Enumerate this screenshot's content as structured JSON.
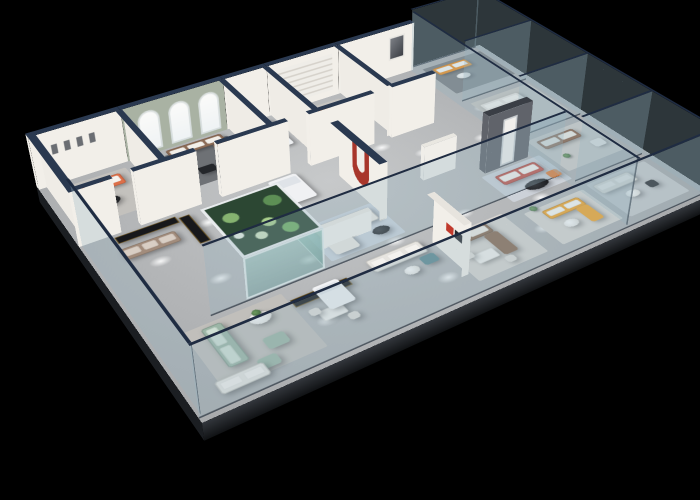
{
  "meta": {
    "description": "3D isometric cutaway rendering of a furniture showroom floor plan on a black background, with white partition walls capped in navy, a sage wall with three arched windows, a planted glass aquarium display, glass perimeter balustrades and many sofa vignettes in orange, brown, teal, sage, red and yellow.",
    "background": "#000000"
  },
  "camera": {
    "perspective": 1100,
    "originX": 373,
    "originY": 190,
    "rotateX": 55,
    "rotateZ": -33,
    "planeW": 560,
    "planeH": 380,
    "planeLeft": 93,
    "planeTop": 0
  },
  "palette": {
    "floor": "#b3b5b7",
    "slabEdge": "#23262b",
    "wallFace": "#f2efe9",
    "wallCap": "#2a3950",
    "sage": "#a9b2a3",
    "charcoal": "#60636a",
    "glass": "rgba(148,178,192,0.30)",
    "glassRail": "#1f2c42",
    "orange": "#ef8d1f",
    "coral": "#dd6f48",
    "red": "#c0544a",
    "brown": "#8d6c56",
    "teal": "#6e8d94",
    "green": "#9cb6a6",
    "yellow": "#f2a42a",
    "cream": "#ebe8e2",
    "cabinet": "#17181b"
  },
  "floor": {
    "edgeDepth": 20
  },
  "walls": [
    {
      "n": "back-wall-room-a",
      "d": "h",
      "x": 0,
      "y": 0,
      "l": 95,
      "t": 8,
      "h": 62,
      "face": "#f2efe9",
      "cap": "#2a3950",
      "f": [
        "s",
        "w"
      ],
      "decal": "frames"
    },
    {
      "n": "back-wall-arch-room",
      "d": "h",
      "x": 95,
      "y": 0,
      "l": 115,
      "t": 8,
      "h": 62,
      "face": "#a9b2a3",
      "cap": "#2a3950",
      "f": [
        "s"
      ],
      "decal": "arches"
    },
    {
      "n": "back-wall-room-c",
      "d": "h",
      "x": 210,
      "y": 0,
      "l": 52,
      "t": 8,
      "h": 62,
      "face": "#f2efe9",
      "cap": "#2a3950",
      "f": [
        "s"
      ]
    },
    {
      "n": "back-wall-room-d",
      "d": "h",
      "x": 262,
      "y": 0,
      "l": 90,
      "t": 8,
      "h": 62,
      "face": "#f2efe9",
      "cap": "#2a3950",
      "f": [
        "s"
      ],
      "decal": "stripes"
    },
    {
      "n": "back-wall-room-e",
      "d": "h",
      "x": 352,
      "y": 0,
      "l": 103,
      "t": 8,
      "h": 62,
      "face": "#f2efe9",
      "cap": "#2a3950",
      "f": [
        "s"
      ],
      "decal": "art"
    },
    {
      "n": "left-outer-wall",
      "d": "v",
      "x": 0,
      "y": 0,
      "l": 118,
      "t": 8,
      "h": 62,
      "face": "#efece6",
      "cap": "#2a3950",
      "f": [
        "e",
        "s"
      ]
    },
    {
      "n": "divider-a-b",
      "d": "v",
      "x": 90,
      "y": 8,
      "l": 106,
      "t": 7,
      "h": 62,
      "face": "#efece6",
      "cap": "#2a3950",
      "f": [
        "e",
        "s"
      ]
    },
    {
      "n": "divider-b-c",
      "d": "v",
      "x": 205,
      "y": 8,
      "l": 106,
      "t": 7,
      "h": 62,
      "face": "#efece6",
      "cap": "#2a3950",
      "f": [
        "e",
        "s"
      ]
    },
    {
      "n": "divider-c-d",
      "d": "v",
      "x": 257,
      "y": 8,
      "l": 106,
      "t": 7,
      "h": 62,
      "face": "#efece6",
      "cap": "#2a3950",
      "f": [
        "e",
        "s"
      ]
    },
    {
      "n": "divider-d-e",
      "d": "v",
      "x": 347,
      "y": 8,
      "l": 106,
      "t": 7,
      "h": 62,
      "face": "#efece6",
      "cap": "#2a3950",
      "f": [
        "e",
        "s"
      ]
    },
    {
      "n": "room-front-wall-1",
      "d": "h",
      "x": 0,
      "y": 112,
      "l": 42,
      "t": 7,
      "h": 62,
      "face": "#f2efe9",
      "cap": "#2a3950",
      "f": [
        "s",
        "e"
      ]
    },
    {
      "n": "room-front-wall-2",
      "d": "h",
      "x": 62,
      "y": 112,
      "l": 64,
      "t": 7,
      "h": 62,
      "face": "#f2efe9",
      "cap": "#2a3950",
      "f": [
        "s",
        "e",
        "w"
      ]
    },
    {
      "n": "room-front-wall-3",
      "d": "h",
      "x": 148,
      "y": 112,
      "l": 78,
      "t": 7,
      "h": 62,
      "face": "#f2efe9",
      "cap": "#2a3950",
      "f": [
        "s",
        "w"
      ]
    },
    {
      "n": "room-front-wall-4",
      "d": "h",
      "x": 250,
      "y": 112,
      "l": 78,
      "t": 7,
      "h": 62,
      "face": "#f2efe9",
      "cap": "#2a3950",
      "f": [
        "s",
        "w"
      ]
    },
    {
      "n": "room-front-wall-5",
      "d": "h",
      "x": 350,
      "y": 112,
      "l": 56,
      "t": 7,
      "h": 62,
      "face": "#f2efe9",
      "cap": "#2a3950",
      "f": [
        "s",
        "w"
      ]
    },
    {
      "n": "red-arch-feature-wall",
      "d": "v",
      "x": 256,
      "y": 150,
      "l": 88,
      "t": 9,
      "h": 66,
      "face": "#f2efe9",
      "cap": "#2a3950",
      "f": [
        "e",
        "s"
      ],
      "decal": "redj"
    },
    {
      "n": "charcoal-feature-wall",
      "d": "h",
      "x": 392,
      "y": 218,
      "l": 56,
      "t": 10,
      "h": 68,
      "face": "#60636a",
      "cap": "#3a3e45",
      "f": [
        "s",
        "w",
        "e"
      ],
      "decal": "door"
    },
    {
      "n": "curved-low-partition",
      "d": "h",
      "x": 186,
      "y": 240,
      "l": 56,
      "t": 6,
      "h": 24,
      "face": "#f4f2ee",
      "cap": "#eceae4",
      "f": [
        "s"
      ]
    },
    {
      "n": "curved-low-partition-2",
      "d": "h",
      "x": 332,
      "y": 198,
      "l": 40,
      "t": 6,
      "h": 40,
      "face": "#f0eee9",
      "cap": "#e9e7e1",
      "f": [
        "s",
        "w"
      ]
    },
    {
      "n": "logo-wall",
      "d": "v",
      "x": 272,
      "y": 292,
      "l": 56,
      "t": 8,
      "h": 58,
      "face": "#f2efe9",
      "cap": "#e7e4de",
      "f": [
        "e",
        "s"
      ],
      "decal": "logo"
    },
    {
      "n": "aquarium-display",
      "d": "h",
      "x": 96,
      "y": 186,
      "l": 80,
      "t": 84,
      "h": 46,
      "face": "aqua",
      "cap": "aqua",
      "f": [
        "s",
        "e"
      ]
    }
  ],
  "glass": [
    {
      "n": "glass-front-balustrade",
      "d": "h",
      "x": 0,
      "y": 372,
      "l": 560,
      "h": 76
    },
    {
      "n": "glass-left-balustrade",
      "d": "v",
      "x": 0,
      "y": 118,
      "l": 254,
      "h": 76
    },
    {
      "n": "glass-right-facade",
      "d": "v",
      "x": 552,
      "y": 0,
      "l": 372,
      "h": 76
    },
    {
      "n": "glass-back-right",
      "d": "h",
      "x": 455,
      "y": 0,
      "l": 97,
      "h": 76
    },
    {
      "n": "glass-mid-partition",
      "d": "h",
      "x": 60,
      "y": 270,
      "l": 392,
      "h": 76
    },
    {
      "n": "glass-wing-main",
      "d": "v",
      "x": 452,
      "y": 8,
      "l": 364,
      "h": 76
    },
    {
      "n": "glass-wing-divider-1",
      "d": "h",
      "x": 459,
      "y": 96,
      "l": 93,
      "h": 76
    },
    {
      "n": "glass-wing-divider-2",
      "d": "h",
      "x": 459,
      "y": 190,
      "l": 93,
      "h": 76
    },
    {
      "n": "glass-wing-divider-3",
      "d": "h",
      "x": 459,
      "y": 286,
      "l": 93,
      "h": 76
    }
  ],
  "furniture": [
    {
      "n": "rug-room-a",
      "t": "rug",
      "x": 10,
      "y": 18,
      "w": 78,
      "h": 76,
      "c": "#c3c1bd"
    },
    {
      "n": "rug-arch-room",
      "t": "rug",
      "x": 114,
      "y": 20,
      "w": 90,
      "h": 70,
      "c": "#6e7175"
    },
    {
      "n": "rug-room-d",
      "t": "rug",
      "x": 264,
      "y": 18,
      "w": 82,
      "h": 70,
      "c": "#c6c4c0"
    },
    {
      "n": "rug-wing-1",
      "t": "rug",
      "x": 464,
      "y": 14,
      "w": 86,
      "h": 68,
      "c": "#7a7d81"
    },
    {
      "n": "rug-center-blue",
      "t": "rug",
      "x": 186,
      "y": 208,
      "w": 82,
      "h": 58,
      "c": "#ccd4dd"
    },
    {
      "n": "rug-feature-room",
      "t": "rug",
      "x": 384,
      "y": 232,
      "w": 76,
      "h": 52,
      "c": "#ccd1d8"
    },
    {
      "n": "rug-green-lounge",
      "t": "rug",
      "x": 30,
      "y": 280,
      "w": 95,
      "h": 80,
      "c": "#c1bfbb"
    },
    {
      "n": "rug-brown-room",
      "t": "rug",
      "x": 282,
      "y": 292,
      "w": 80,
      "h": 70,
      "c": "#d7d4d0"
    },
    {
      "n": "rug-yellow-room",
      "t": "rug",
      "x": 380,
      "y": 304,
      "w": 76,
      "h": 58,
      "c": "#d8d5d1"
    },
    {
      "n": "rug-wing-2",
      "t": "rug",
      "x": 464,
      "y": 108,
      "w": 84,
      "h": 70,
      "c": "#c6c4c0"
    },
    {
      "n": "rug-wing-3",
      "t": "rug",
      "x": 466,
      "y": 204,
      "w": 80,
      "h": 68,
      "c": "#cfccc8"
    },
    {
      "n": "rug-wing-4",
      "t": "rug",
      "x": 464,
      "y": 300,
      "w": 80,
      "h": 64,
      "c": "#c6c8ca"
    },
    {
      "n": "sofa-coral-room-a",
      "t": "sofa",
      "x": 16,
      "y": 26,
      "w": 62,
      "h": 20,
      "c": "#dd6f48",
      "cu": "#f6f3ee"
    },
    {
      "n": "coffee-table-room-a",
      "t": "tableRD",
      "x": 36,
      "y": 58,
      "w": 26,
      "h": 18
    },
    {
      "n": "chaise-orange-arch-room",
      "t": "block",
      "x": 100,
      "y": 26,
      "w": 17,
      "h": 46,
      "c": "#ef8d1f"
    },
    {
      "n": "sofa-brown-arch-room",
      "t": "sofa",
      "x": 134,
      "y": 14,
      "w": 64,
      "h": 16,
      "c": "#8d6c56",
      "cu": "#f3efe9"
    },
    {
      "n": "sofa-arm-arch-room",
      "t": "block",
      "x": 181,
      "y": 30,
      "w": 17,
      "h": 42,
      "c": "#8d6c56"
    },
    {
      "n": "side-table-arch-1",
      "t": "tableSQ",
      "x": 126,
      "y": 54,
      "w": 18,
      "h": 13
    },
    {
      "n": "side-table-arch-2",
      "t": "tableSQ",
      "x": 148,
      "y": 62,
      "w": 18,
      "h": 13
    },
    {
      "n": "bed-room-c",
      "t": "bed",
      "x": 214,
      "y": 16,
      "w": 42,
      "h": 58,
      "c": "#eef0f2",
      "b": "#c3cfdd"
    },
    {
      "n": "sofa-teal-room-d",
      "t": "sofa",
      "x": 270,
      "y": 26,
      "w": 58,
      "h": 18,
      "c": "#6e8d94",
      "cu": "#e8a06b"
    },
    {
      "n": "coffee-table-room-d",
      "t": "tableRD",
      "x": 290,
      "y": 56,
      "w": 22,
      "h": 15
    },
    {
      "n": "sofa-white-room-e",
      "t": "sofa",
      "x": 360,
      "y": 26,
      "w": 48,
      "h": 16,
      "c": "#e9e6e0",
      "cu": "#f8f7f4"
    },
    {
      "n": "table-room-e",
      "t": "tableRD",
      "x": 374,
      "y": 50,
      "w": 16,
      "h": 12
    },
    {
      "n": "sofa-orange-wing-1",
      "t": "sofa",
      "x": 472,
      "y": 22,
      "w": 48,
      "h": 17,
      "c": "#ef8d1f",
      "cu": "#fdfcfa"
    },
    {
      "n": "table-wing-1",
      "t": "tableRL",
      "x": 486,
      "y": 48,
      "w": 18,
      "h": 12
    },
    {
      "n": "sofa-white-wing-2",
      "t": "sofa",
      "x": 468,
      "y": 118,
      "w": 54,
      "h": 18,
      "c": "#e5e3de",
      "cu": "#f4f2ee"
    },
    {
      "n": "table-wing-2",
      "t": "tableRD",
      "x": 486,
      "y": 146,
      "w": 18,
      "h": 12
    },
    {
      "n": "sofa-brown-wing-3",
      "t": "sofa",
      "x": 472,
      "y": 212,
      "w": 50,
      "h": 18,
      "c": "#8a5f46",
      "cu": "#f0ece5"
    },
    {
      "n": "armchair-wing-3",
      "t": "chair",
      "x": 520,
      "y": 242,
      "w": 15,
      "h": 13,
      "c": "#f0eeea"
    },
    {
      "n": "sofa-gray-wing-4",
      "t": "sofa",
      "x": 466,
      "y": 306,
      "w": 48,
      "h": 17,
      "c": "#dddbd6",
      "cu": "#efede9"
    },
    {
      "n": "office-chair-wing-4",
      "t": "chair",
      "x": 514,
      "y": 330,
      "w": 12,
      "h": 11,
      "c": "#2c2e32"
    },
    {
      "n": "table-wing-4",
      "t": "tableRL",
      "x": 484,
      "y": 332,
      "w": 16,
      "h": 11
    },
    {
      "n": "media-cabinet-long",
      "t": "cab",
      "x": 32,
      "y": 126,
      "w": 62,
      "h": 11
    },
    {
      "n": "sofa-taupe",
      "t": "sofa",
      "x": 28,
      "y": 146,
      "w": 56,
      "h": 18,
      "c": "#a28c7c",
      "cu": "#d9cec4"
    },
    {
      "n": "display-cabinet-tall",
      "t": "cab",
      "x": 96,
      "y": 130,
      "w": 11,
      "h": 48
    },
    {
      "n": "bed-display-mid",
      "t": "bed",
      "x": 196,
      "y": 124,
      "w": 32,
      "h": 46,
      "c": "#f0f1f3",
      "b": "#dfe3e8"
    },
    {
      "n": "sofa-cream-center",
      "t": "sofa",
      "x": 194,
      "y": 214,
      "w": 64,
      "h": 22,
      "c": "#ebe8e2",
      "cu": "#f7f6f2"
    },
    {
      "n": "chaise-cream-center",
      "t": "block",
      "x": 194,
      "y": 236,
      "w": 26,
      "h": 26,
      "c": "#ebe8e2"
    },
    {
      "n": "table-center",
      "t": "tableRD",
      "x": 240,
      "y": 246,
      "w": 18,
      "h": 12
    },
    {
      "n": "navy-round-ottoman",
      "t": "ottoE",
      "x": 436,
      "y": 188,
      "w": 26,
      "h": 20,
      "c": "#2c3a52"
    },
    {
      "n": "sofa-red-feature",
      "t": "sofa",
      "x": 394,
      "y": 240,
      "w": 52,
      "h": 18,
      "c": "#c0544a",
      "cu": "#f4f1ec"
    },
    {
      "n": "oval-table-feature",
      "t": "tableRD",
      "x": 408,
      "y": 266,
      "w": 28,
      "h": 15
    },
    {
      "n": "armchair-orange-leather",
      "t": "chair",
      "x": 442,
      "y": 262,
      "w": 14,
      "h": 12,
      "c": "#dd7e3c"
    },
    {
      "n": "sofa-green-vertical",
      "t": "sofa",
      "x": 44,
      "y": 286,
      "w": 19,
      "h": 54,
      "c": "#9cb6a6",
      "cu": "#cfe0d4"
    },
    {
      "n": "ottoman-green-1",
      "t": "block",
      "x": 82,
      "y": 324,
      "w": 20,
      "h": 15,
      "c": "#9cb6a6"
    },
    {
      "n": "ottoman-green-2",
      "t": "block",
      "x": 66,
      "y": 344,
      "w": 18,
      "h": 13,
      "c": "#9cb6a6"
    },
    {
      "n": "table-green-lounge",
      "t": "tableRL",
      "x": 84,
      "y": 292,
      "w": 20,
      "h": 15
    },
    {
      "n": "plant-green-table",
      "t": "plant",
      "x": 90,
      "y": 288,
      "w": 8,
      "h": 8
    },
    {
      "n": "sofa-white-front-left",
      "t": "sofa",
      "x": 26,
      "y": 348,
      "w": 44,
      "h": 16,
      "c": "#e6e4df",
      "cu": "#f2f0ec"
    },
    {
      "n": "display-cabinet-front",
      "t": "cab",
      "x": 126,
      "y": 294,
      "w": 58,
      "h": 11
    },
    {
      "n": "dining-table-front",
      "t": "tableRect",
      "x": 138,
      "y": 320,
      "w": 24,
      "h": 14
    },
    {
      "n": "dining-chair-1",
      "t": "chair",
      "x": 132,
      "y": 314,
      "w": 10,
      "h": 9,
      "c": "#dfddd8"
    },
    {
      "n": "dining-chair-2",
      "t": "chair",
      "x": 158,
      "y": 336,
      "w": 10,
      "h": 9,
      "c": "#dfddd8"
    },
    {
      "n": "daybed-front",
      "t": "bed",
      "x": 150,
      "y": 290,
      "w": 26,
      "h": 34,
      "c": "#f1f2f4",
      "b": "#e2e6ea"
    },
    {
      "n": "sofa-white-front-center",
      "t": "sofa",
      "x": 210,
      "y": 284,
      "w": 58,
      "h": 19,
      "c": "#e7e5e0",
      "cu": "#f4f2ee"
    },
    {
      "n": "ottoman-teal-cube",
      "t": "block",
      "x": 254,
      "y": 306,
      "w": 16,
      "h": 13,
      "c": "#5d8a92"
    },
    {
      "n": "table-front-center",
      "t": "tableRL",
      "x": 232,
      "y": 312,
      "w": 15,
      "h": 11
    },
    {
      "n": "sofa-brown-sectional",
      "t": "sofa",
      "x": 286,
      "y": 296,
      "w": 52,
      "h": 16,
      "c": "#8a6a52",
      "cu": "#f0ebe4"
    },
    {
      "n": "sofa-brown-arm",
      "t": "block",
      "x": 324,
      "y": 312,
      "w": 16,
      "h": 34,
      "c": "#8a6a52"
    },
    {
      "n": "dining-table-2",
      "t": "tableRect",
      "x": 296,
      "y": 330,
      "w": 24,
      "h": 14
    },
    {
      "n": "dining-chair-3",
      "t": "chair",
      "x": 290,
      "y": 324,
      "w": 10,
      "h": 9,
      "c": "#dfddd8"
    },
    {
      "n": "dining-chair-4",
      "t": "chair",
      "x": 320,
      "y": 348,
      "w": 10,
      "h": 9,
      "c": "#dfddd8"
    },
    {
      "n": "sofa-yellow",
      "t": "sofa",
      "x": 395,
      "y": 312,
      "w": 46,
      "h": 15,
      "c": "#f2a42a",
      "cu": "#fbf9f4"
    },
    {
      "n": "sofa-yellow-arm",
      "t": "block",
      "x": 426,
      "y": 326,
      "w": 15,
      "h": 26,
      "c": "#f2a42a"
    },
    {
      "n": "table-yellow-room",
      "t": "tableRL",
      "x": 400,
      "y": 336,
      "w": 16,
      "h": 11
    },
    {
      "n": "plant-yellow-room",
      "t": "plant",
      "x": 388,
      "y": 300,
      "w": 8,
      "h": 8
    },
    {
      "n": "plant-wing-3",
      "t": "plant",
      "x": 478,
      "y": 246,
      "w": 8,
      "h": 8
    }
  ],
  "lights": [
    [
      70,
      70
    ],
    [
      160,
      58
    ],
    [
      240,
      58
    ],
    [
      312,
      60
    ],
    [
      390,
      70
    ],
    [
      118,
      150
    ],
    [
      200,
      152
    ],
    [
      282,
      162
    ],
    [
      362,
      162
    ],
    [
      432,
      172
    ],
    [
      90,
      232
    ],
    [
      170,
      252
    ],
    [
      252,
      272
    ],
    [
      332,
      272
    ],
    [
      412,
      292
    ],
    [
      142,
      332
    ],
    [
      262,
      342
    ],
    [
      382,
      332
    ],
    [
      470,
      122
    ],
    [
      492,
      262
    ],
    [
      330,
      130
    ],
    [
      55,
      180
    ]
  ]
}
